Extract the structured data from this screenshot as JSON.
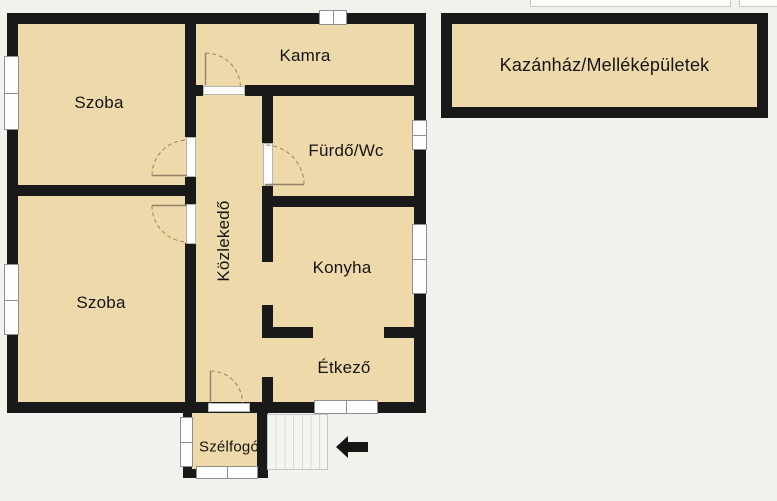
{
  "palette": {
    "background": "#f2f1ec",
    "room_fill": "#eed9ab",
    "wall": "#191919",
    "window_fill": "#fdfdfd",
    "window_border": "#8f8f8f",
    "door_arc": "#a5804f",
    "stairs_fill": "#f4f4f1",
    "stairs_line": "#d7d7d2",
    "arrow": "#161616",
    "label": "#151515"
  },
  "floorplan": {
    "rooms": [
      {
        "id": "szoba-1",
        "label": "Szoba"
      },
      {
        "id": "szoba-2",
        "label": "Szoba"
      },
      {
        "id": "kamra",
        "label": "Kamra"
      },
      {
        "id": "furdo-wc",
        "label": "Fürdő/Wc"
      },
      {
        "id": "kozlekedo",
        "label": "Közlekedő"
      },
      {
        "id": "konyha",
        "label": "Konyha"
      },
      {
        "id": "etkezo",
        "label": "Étkező"
      },
      {
        "id": "szelfogo",
        "label": "Szélfogó"
      }
    ],
    "outbuilding": {
      "label": "Kazánház/Melléképületek"
    },
    "icons": {
      "entrance_arrow": "left-arrow"
    }
  }
}
